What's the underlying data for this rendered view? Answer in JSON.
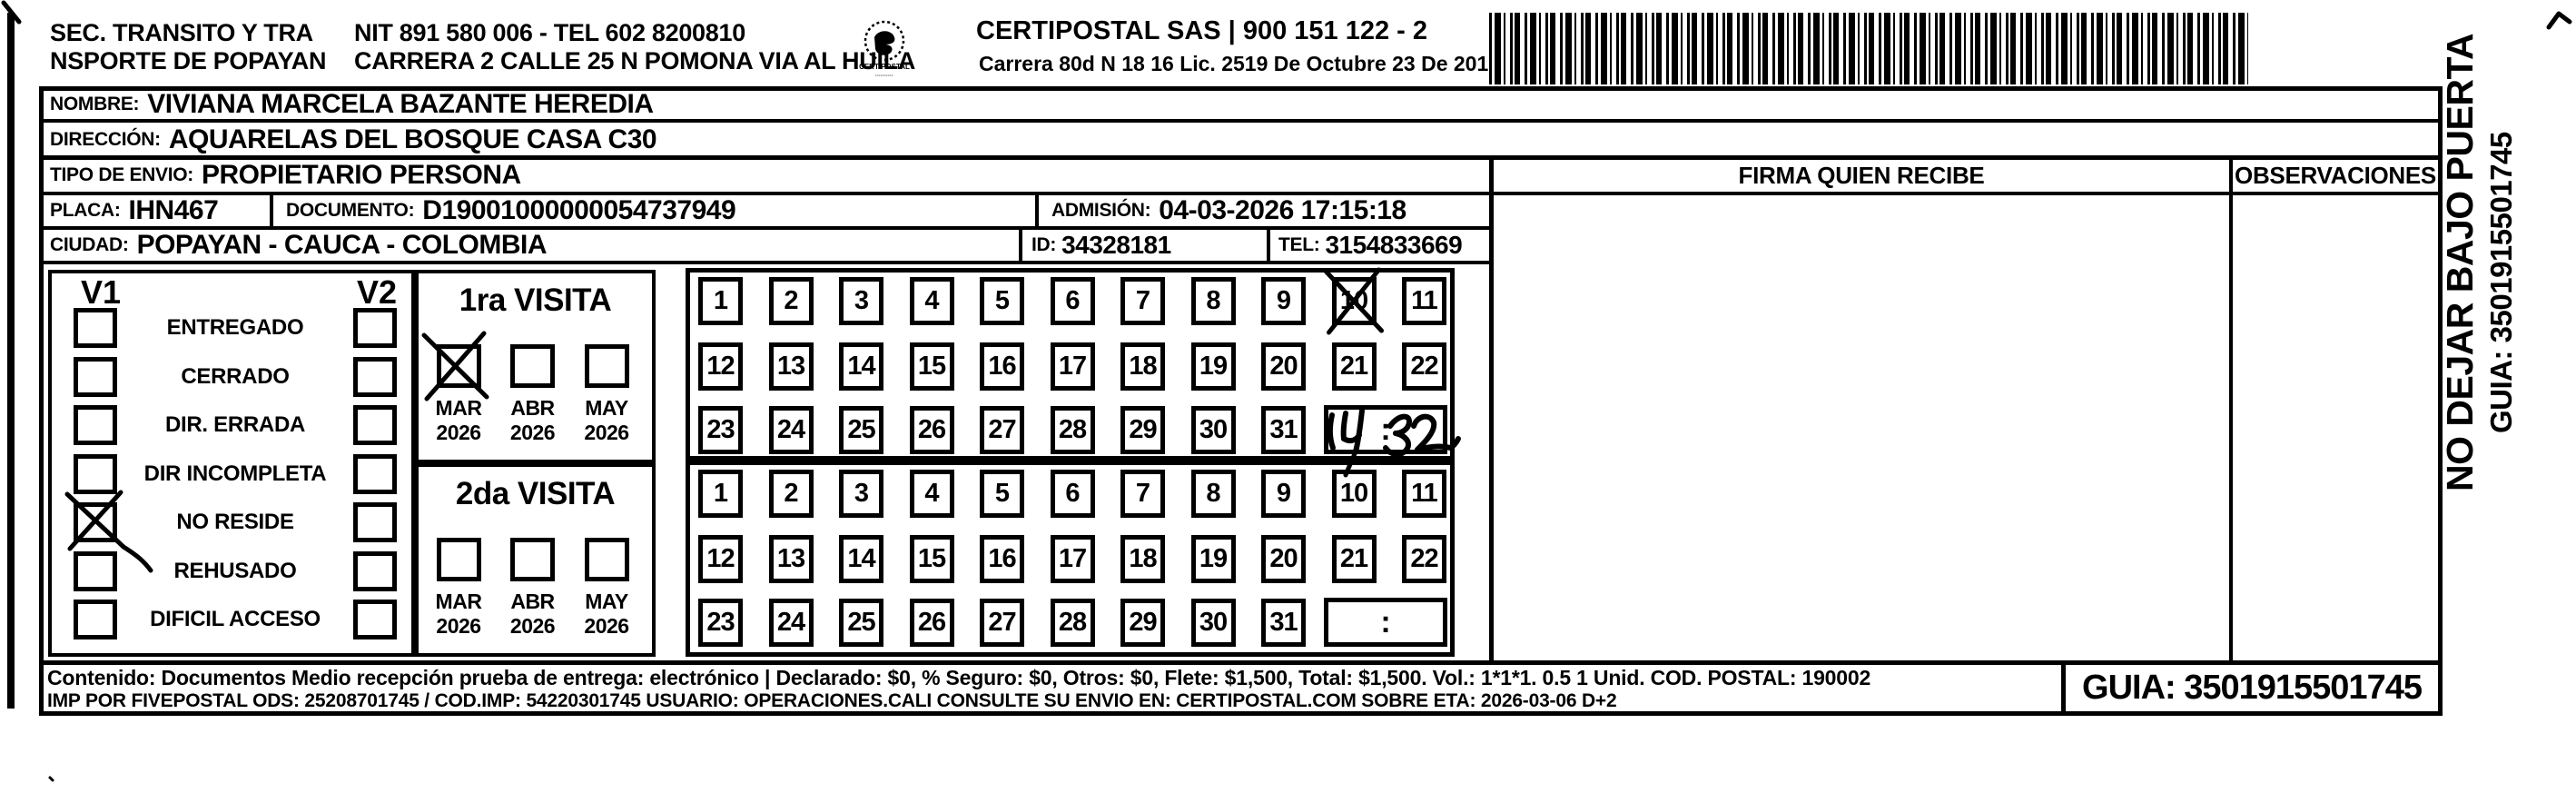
{
  "header": {
    "org_name_line1": "SEC. TRANSITO Y TRA",
    "org_name_line2": "NSPORTE DE POPAYAN",
    "nit_tel": "NIT 891 580 006 - TEL 602 8200810",
    "org_address": "CARRERA 2 CALLE 25 N POMONA VIA AL HUILA",
    "company_name": "CERTIPOSTAL SAS | 900 151 122 - 2",
    "company_address": "Carrera 80d N 18 16  Lic. 2519 De Octubre 23 De 2015",
    "logo_caption": "CERTIPOSTAL"
  },
  "shipment": {
    "nombre_label": "NOMBRE:",
    "nombre_value": "VIVIANA MARCELA BAZANTE HEREDIA",
    "direccion_label": "DIRECCIÓN:",
    "direccion_value": "AQUARELAS DEL BOSQUE CASA C30",
    "tipo_envio_label": "TIPO DE ENVIO:",
    "tipo_envio_value": "PROPIETARIO PERSONA",
    "placa_label": "PLACA:",
    "placa_value": "IHN467",
    "documento_label": "DOCUMENTO:",
    "documento_value": "D19001000000054737949",
    "admision_label": "ADMISIÓN:",
    "admision_value": "04-03-2026 17:15:18",
    "ciudad_label": "CIUDAD:",
    "ciudad_value": "POPAYAN - CAUCA - COLOMBIA",
    "id_label": "ID:",
    "id_value": "34328181",
    "tel_label": "TEL:",
    "tel_value": "3154833669"
  },
  "delivery_status": {
    "col1_header": "V1",
    "col2_header": "V2",
    "options": [
      "ENTREGADO",
      "CERRADO",
      "DIR. ERRADA",
      "DIR INCOMPLETA",
      "NO RESIDE",
      "REHUSADO",
      "DIFICIL ACCESO"
    ],
    "v1_checked_option": "NO RESIDE",
    "v1_checked_index": 4,
    "v2_checked_index": null
  },
  "visits": {
    "time_separator": ":",
    "first": {
      "title": "1ra VISITA",
      "months": [
        {
          "month": "MAR",
          "year": "2026"
        },
        {
          "month": "ABR",
          "year": "2026"
        },
        {
          "month": "MAY",
          "year": "2026"
        }
      ],
      "checked_month_index": 0,
      "days": [
        1,
        2,
        3,
        4,
        5,
        6,
        7,
        8,
        9,
        10,
        11,
        12,
        13,
        14,
        15,
        16,
        17,
        18,
        19,
        20,
        21,
        22,
        23,
        24,
        25,
        26,
        27,
        28,
        29,
        30,
        31
      ],
      "crossed_day": 10,
      "time_handwritten": "14:32"
    },
    "second": {
      "title": "2da VISITA",
      "months": [
        {
          "month": "MAR",
          "year": "2026"
        },
        {
          "month": "ABR",
          "year": "2026"
        },
        {
          "month": "MAY",
          "year": "2026"
        }
      ],
      "checked_month_index": null,
      "days": [
        1,
        2,
        3,
        4,
        5,
        6,
        7,
        8,
        9,
        10,
        11,
        12,
        13,
        14,
        15,
        16,
        17,
        18,
        19,
        20,
        21,
        22,
        23,
        24,
        25,
        26,
        27,
        28,
        29,
        30,
        31
      ],
      "crossed_day": null,
      "time_handwritten": ""
    }
  },
  "signature": {
    "firma_header": "FIRMA QUIEN RECIBE",
    "observaciones_header": "OBSERVACIONES"
  },
  "side_notice": {
    "warning": "NO DEJAR BAJO PUERTA",
    "guia": "GUIA: 3501915501745"
  },
  "footer": {
    "line1": "Contenido: Documentos Medio recepción prueba de entrega: electrónico | Declarado: $0, % Seguro: $0, Otros: $0, Flete: $1,500, Total: $1,500. Vol.: 1*1*1. 0.5  1 Unid. COD. POSTAL: 190002",
    "line2": "IMP POR FIVEPOSTAL ODS: 25208701745 / COD.IMP: 54220301745 USUARIO: OPERACIONES.CALI CONSULTE SU ENVIO EN: CERTIPOSTAL.COM SOBRE ETA: 2026-03-06 D+2",
    "guia": "GUIA: 3501915501745"
  }
}
